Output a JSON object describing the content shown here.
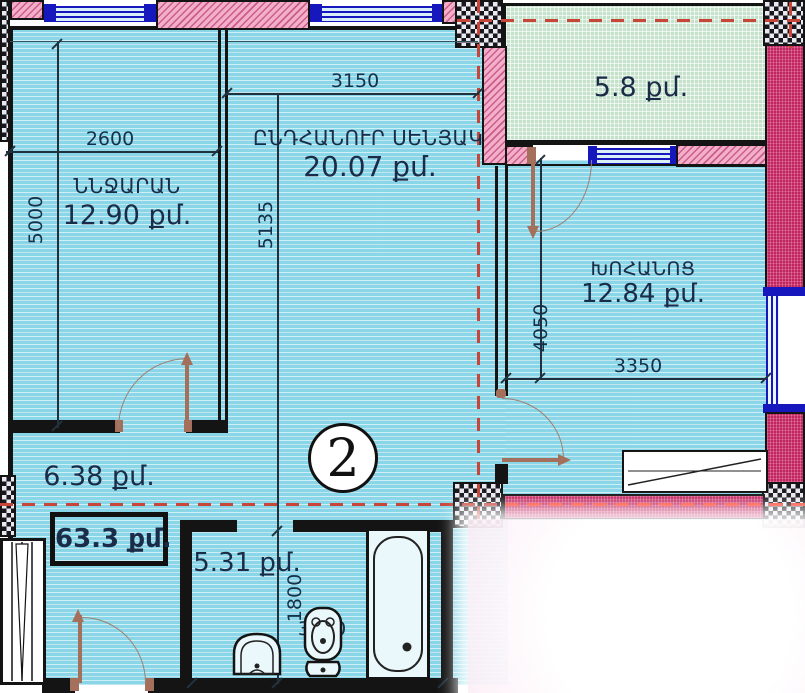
{
  "apartment": {
    "number": "2",
    "total_area_label": "63.3 քմ."
  },
  "rooms": {
    "bedroom": {
      "name": "ՆՆՋԱՐԱՆ",
      "area": "12.90 քմ.",
      "width_mm": "2600",
      "height_mm": "5000"
    },
    "living_room": {
      "name": "ԸՆԴՀԱՆՈՒՐ ՍԵՆՅԱԿ",
      "area": "20.07 քմ.",
      "width_mm": "3150",
      "height_mm": "5135"
    },
    "kitchen": {
      "name": "ԽՈՀԱՆՈՑ",
      "area": "12.84 քմ.",
      "width_mm": "3350",
      "height_mm": "4050"
    },
    "balcony": {
      "area": "5.8 քմ."
    },
    "hallway": {
      "area": "6.38 քմ."
    },
    "bathroom": {
      "area": "5.31 քմ.",
      "width_mm": "3000",
      "height_mm": "1800"
    }
  },
  "colors": {
    "floor_cyan": "#89D6E8",
    "balcony_green": "#C3E2C9",
    "wall_pink_hatch": "#F3AEC8",
    "wall_magenta": "#C0255F",
    "window_blue": "#1717BE",
    "door_brown": "#A5705B",
    "boundary_dash_red": "#C8453A",
    "label_navy": "#1A2C47"
  }
}
